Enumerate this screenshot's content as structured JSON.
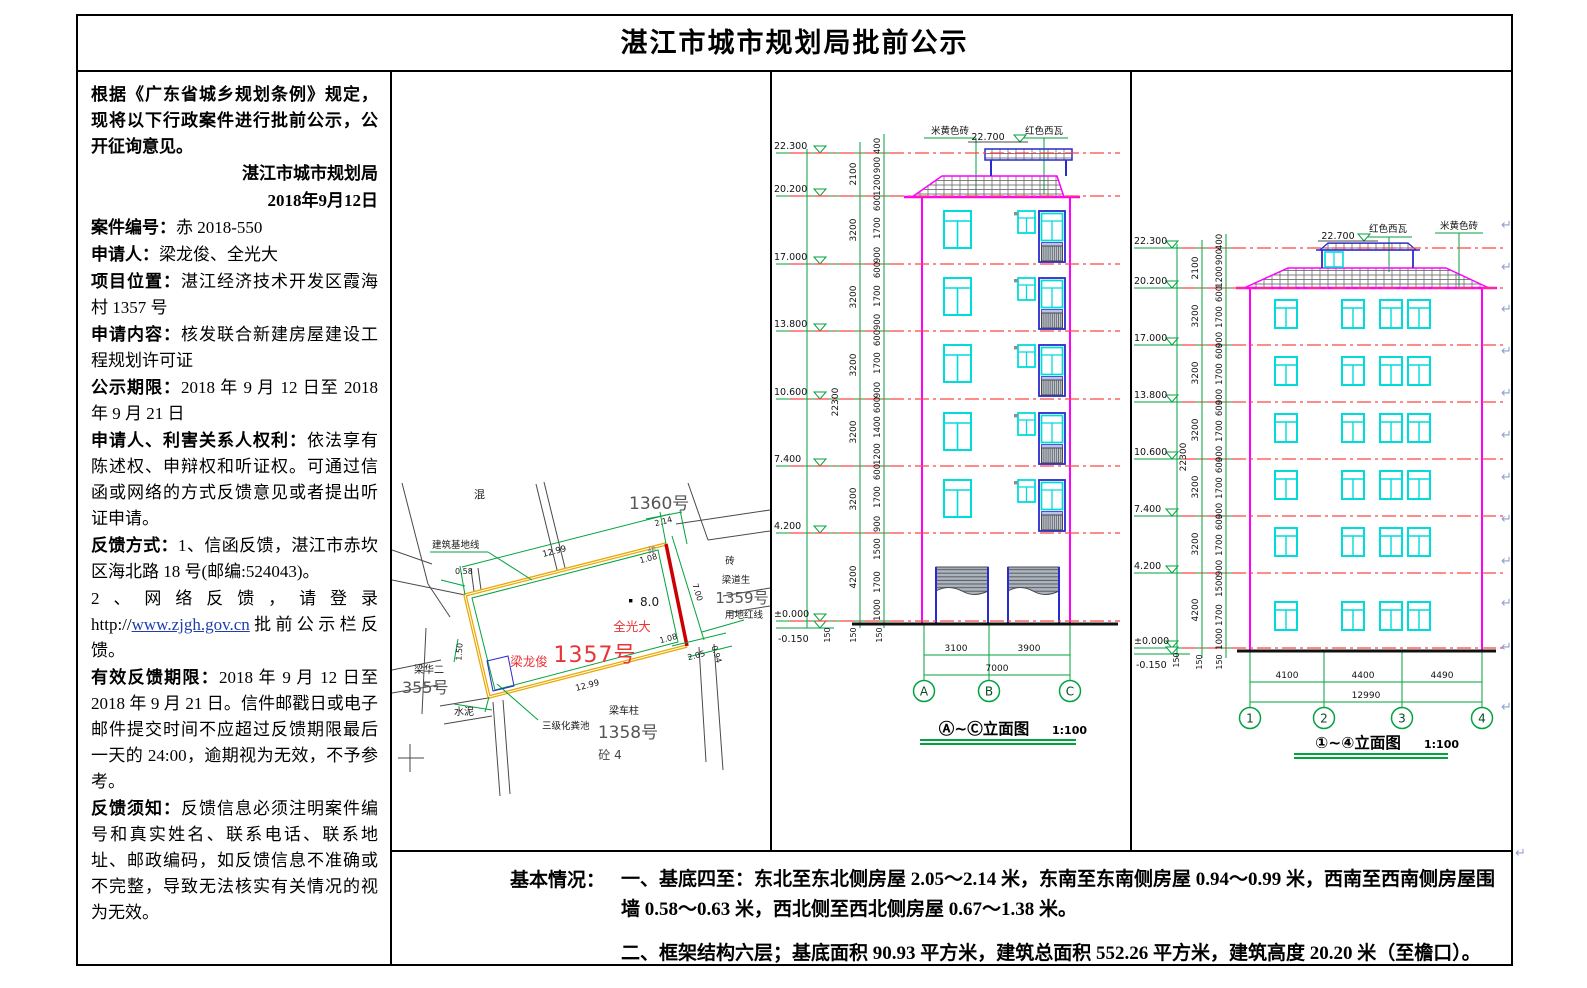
{
  "header": {
    "title": "湛江市城市规划局批前公示"
  },
  "left_panel": {
    "intro": "根据《广东省城乡规划条例》规定，现将以下行政案件进行批前公示，公开征询意见。",
    "org": "湛江市城市规划局",
    "date": "2018年9月12日",
    "fields": [
      {
        "label": "案件编号：",
        "text": "赤 2018-550"
      },
      {
        "label": "申请人：",
        "text": "梁龙俊、全光大"
      },
      {
        "label": "项目位置：",
        "text": "湛江经济技术开发区霞海村 1357 号"
      },
      {
        "label": "申请内容：",
        "text": "核发联合新建房屋建设工程规划许可证"
      },
      {
        "label": "公示期限：",
        "text": "2018 年 9 月 12 日至 2018 年 9 月 21 日"
      },
      {
        "label": "申请人、利害关系人权利：",
        "text": "依法享有陈述权、申辩权和听证权。可通过信函或网络的方式反馈意见或者提出听证申请。"
      },
      {
        "label": "反馈方式：",
        "text": "1、信函反馈，湛江市赤坎区海北路 18 号(邮编:524043)。"
      }
    ],
    "web_feedback": {
      "pre": "2、网络反馈，请登录 http://",
      "link": "www.zjgh.gov.cn",
      "post": "批前公示栏反馈。"
    },
    "fields2": [
      {
        "label": "有效反馈期限：",
        "text": "2018 年 9 月 12 日至 2018 年 9 月 21 日。信件邮戳日或电子邮件提交时间不应超过反馈期限最后一天的 24:00，逾期视为无效，不予参考。"
      },
      {
        "label": "反馈须知：",
        "text": "反馈信息必须注明案件编号和真实姓名、联系电话、联系地址、邮政编码，如反馈信息不准确或不完整，导致无法核实有关情况的视为无效。"
      }
    ]
  },
  "siteplan": {
    "parcels": {
      "n1360": "1360号",
      "n1359": "1359号",
      "n1358": "1358号",
      "n355": "355号",
      "n1357": "1357号"
    },
    "names": {
      "quanguangda": "全光大",
      "lianglongjun": "梁龙俊",
      "liangdaosheng": "梁道生",
      "lianghuaer": "梁华二",
      "liangchezhu": "梁车柱"
    },
    "notes": {
      "hun": "混",
      "zhuan_ne": "砖",
      "zhuan_e": "砖",
      "shuini": "水泥",
      "tong": "砼 4",
      "septic": "三级化粪池",
      "red_line": "用地红线",
      "base_line": "建筑基地线",
      "spot": "8.0"
    },
    "dims": {
      "top": "12.99",
      "bottom": "12.99",
      "right": "7.00",
      "left": "1.50",
      "ne": "2.14",
      "e1": "1.08",
      "e2": "1.08",
      "s1": "2.05",
      "s2": "0.94",
      "w1": "0.58"
    }
  },
  "elev1": {
    "levels": [
      "22.300",
      "20.200",
      "17.000",
      "13.800",
      "10.600",
      "7.400",
      "4.200",
      "±0.000"
    ],
    "below_level": "-0.150",
    "total": "22300",
    "chain1": [
      "2100",
      "3200",
      "3200",
      "3200",
      "3200",
      "3200",
      "4200"
    ],
    "chain2": [
      "400",
      "900",
      "1200",
      "600",
      "1700",
      "900",
      "600",
      "1700",
      "900",
      "600",
      "1700",
      "900",
      "600",
      "1400",
      "1200",
      "600",
      "1700",
      "900",
      "1500",
      "1700",
      "1000"
    ],
    "base": [
      "150",
      "150",
      "150"
    ],
    "ridge": "22.700",
    "brick": "米黄色砖",
    "tile": "红色西瓦",
    "spans": [
      "3100",
      "3900"
    ],
    "span_total": "7000",
    "axes": [
      "A",
      "B",
      "C"
    ],
    "title": "Ⓐ~Ⓒ立面图",
    "scale": "1:100"
  },
  "elev2": {
    "levels": [
      "22.300",
      "20.200",
      "17.000",
      "13.800",
      "10.600",
      "7.400",
      "4.200",
      "±0.000"
    ],
    "below_level": "-0.150",
    "total": "22300",
    "chain1": [
      "2100",
      "3200",
      "3200",
      "3200",
      "3200",
      "3200",
      "4200"
    ],
    "chain2": [
      "400",
      "900",
      "1200",
      "600",
      "1700",
      "900",
      "600",
      "1700",
      "900",
      "600",
      "1700",
      "900",
      "600",
      "1700",
      "900",
      "600",
      "1700",
      "900",
      "1500",
      "1700",
      "1000"
    ],
    "base": [
      "150",
      "150",
      "150"
    ],
    "ridge": "22.700",
    "brick": "米黄色砖",
    "tile": "红色西瓦",
    "spans": [
      "4100",
      "4400",
      "4490"
    ],
    "span_total": "12990",
    "axes": [
      "1",
      "2",
      "3",
      "4"
    ],
    "title": "①~④立面图",
    "scale": "1:100"
  },
  "basic": {
    "label": "基本情况：",
    "item1": "一、基底四至：东北至东北侧房屋 2.05～2.14 米，东南至东南侧房屋 0.94～0.99 米，西南至西南侧房屋围墙 0.58～0.63 米，西北侧至西北侧房屋 0.67～1.38 米。",
    "item2": "二、框架结构六层；基底面积 90.93 平方米，建筑总面积 552.26 平方米，建筑高度 20.20 米（至檐口）。"
  },
  "artifact": {
    "pilcrow": "↵"
  },
  "colors": {
    "cad_green": "#00a33e",
    "magenta": "#ff00ff",
    "cyan": "#00dcdc",
    "red_dash": "#ff4545",
    "blue": "#2a2ad0",
    "plot_yellow": "#eaa800",
    "plot_red": "#cc0000",
    "red_text": "#e83434",
    "link_blue": "#1f3db0"
  }
}
